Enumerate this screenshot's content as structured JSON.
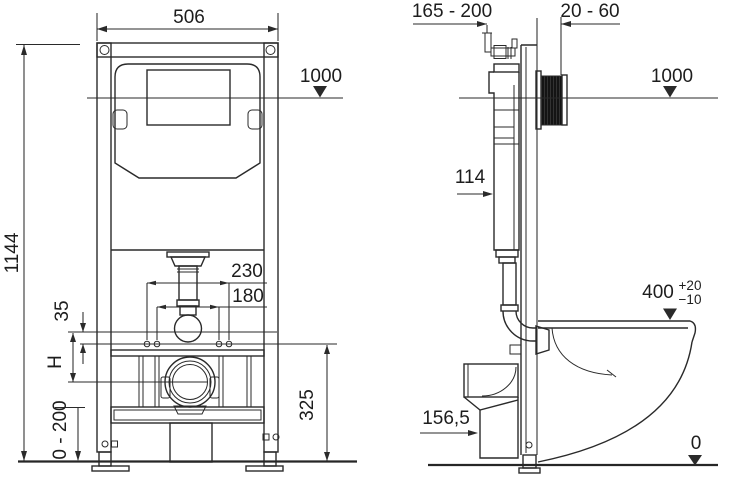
{
  "labels": {
    "front_width": "506",
    "front_height": "1144",
    "front_level": "1000",
    "bolt_spacing_outer": "230",
    "bolt_spacing_inner": "180",
    "offset_small": "35",
    "outlet_center_var": "H",
    "foot_adjust_range": "0 - 200",
    "outlet_center_height": "325",
    "depth_range": "165 - 200",
    "wall_distance_range": "20 - 60",
    "side_level": "1000",
    "cistern_depth": "114",
    "bowl_height": "400",
    "bowl_height_tol_plus": "+20",
    "bowl_height_tol_minus": "−10",
    "drain_center_height": "156,5",
    "floor_level": "0"
  },
  "colors": {
    "line": "#2a2a2a",
    "text": "#1d1d1d",
    "hatch_fill": "#141414",
    "background": "#ffffff"
  }
}
